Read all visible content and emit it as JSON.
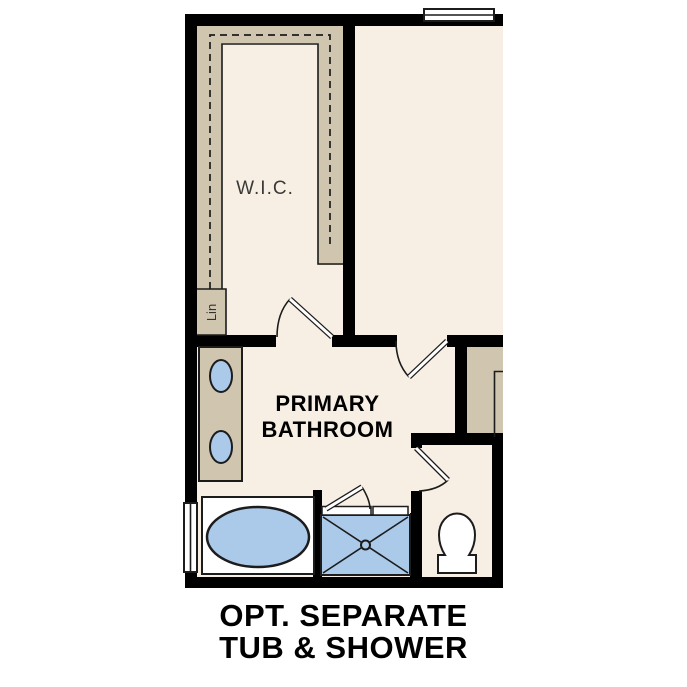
{
  "figure": {
    "type": "floor-plan-option-diagram",
    "caption": {
      "line1": "OPT. SEPARATE",
      "line2": "TUB & SHOWER"
    },
    "rooms": {
      "wic_label": "W.I.C.",
      "linen_label": "Lin",
      "bathroom_label_line1": "PRIMARY",
      "bathroom_label_line2": "BATHROOM"
    },
    "fixtures": [
      "double-vanity-sinks",
      "oval-soaking-tub",
      "separate-shower-with-center-drain",
      "toilet",
      "closet-rod-dashed-line",
      "top-wall-window",
      "left-wall-window"
    ],
    "colors": {
      "floor": "#f7efe3",
      "cabinet": "#d0c5af",
      "fixture": "#abc9e9",
      "wall": "#000000",
      "line": "#1c1c1c",
      "label": "#000000",
      "wic_label": "#3a3a3a"
    }
  }
}
